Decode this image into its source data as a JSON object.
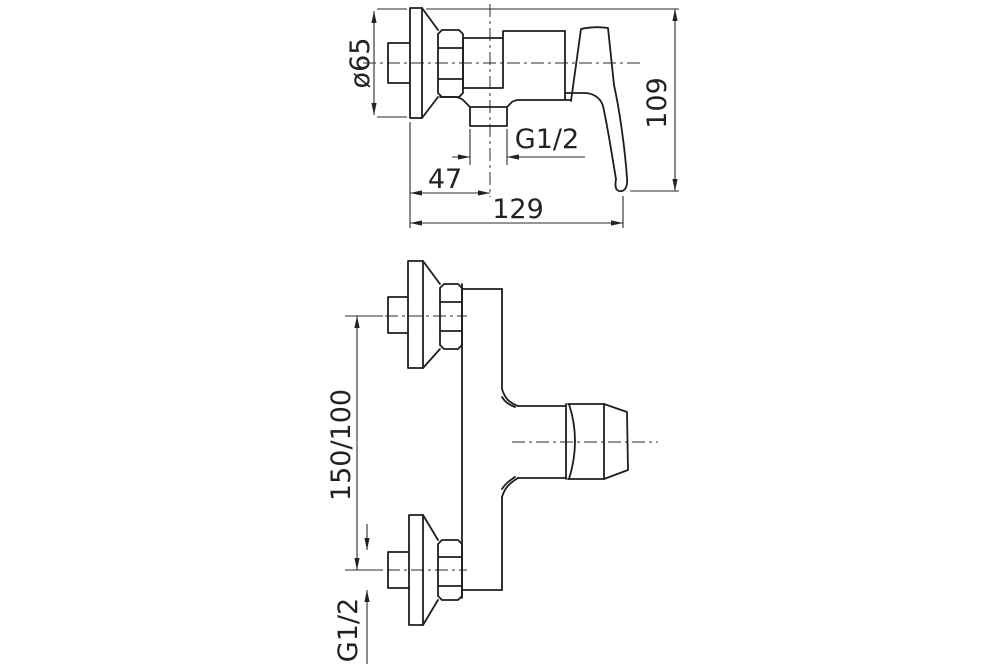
{
  "drawing": {
    "description": "Technical dimension drawing of a wall-mounted single-lever shower mixer, two orthographic views",
    "side_view": {
      "labels": {
        "flange_diameter": "ø65",
        "outlet_thread": "G1/2",
        "wall_to_outlet": "47",
        "overall_depth": "129",
        "overall_height": "109"
      }
    },
    "front_view": {
      "labels": {
        "connection_spacing": "150/100",
        "connection_thread": "G1/2"
      }
    }
  }
}
